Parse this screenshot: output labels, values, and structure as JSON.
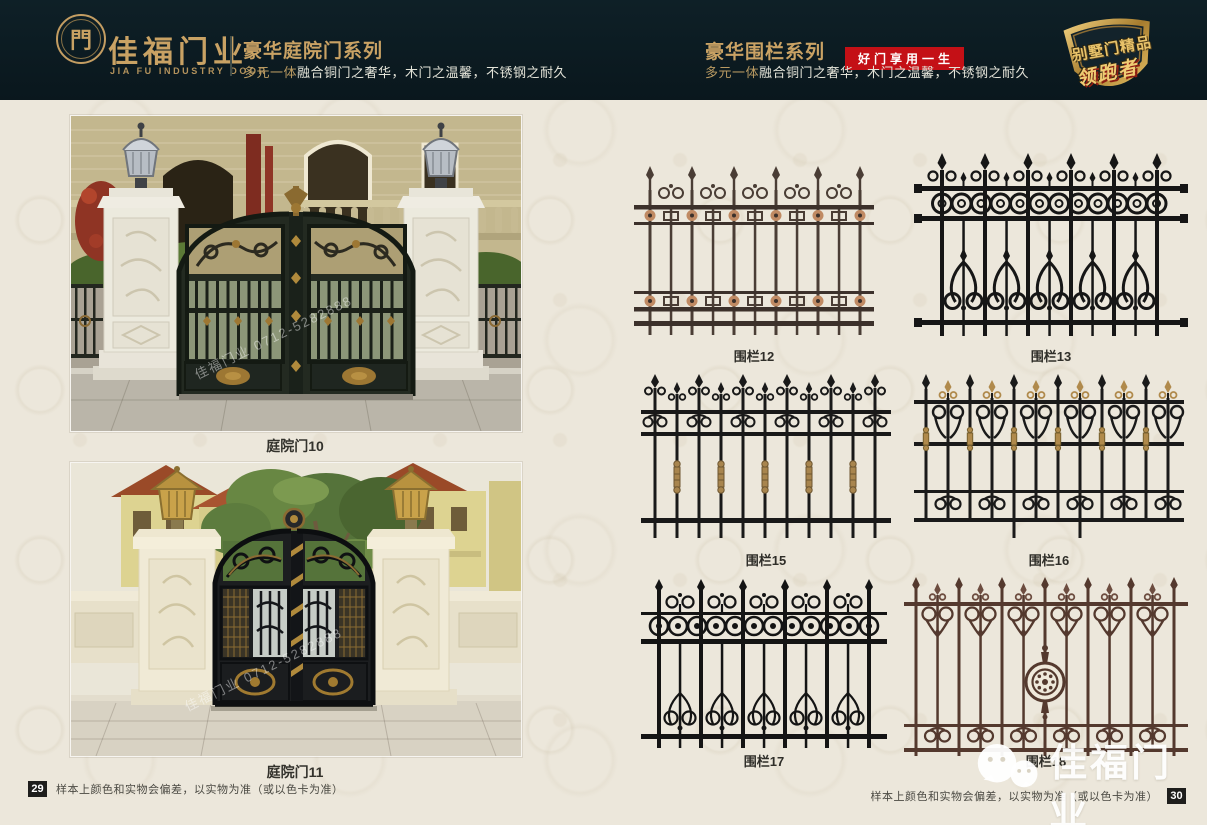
{
  "header": {
    "logo": {
      "glyph": "門",
      "brand_cn": "佳福门业",
      "brand_en": "JIA FU INDUSTRY DOOR"
    },
    "series_left": {
      "title": "豪华庭院门系列",
      "subtitle_em": "多元一体",
      "subtitle_rest": "融合铜门之奢华，木门之温馨，不锈钢之耐久"
    },
    "series_right": {
      "title": "豪华围栏系列",
      "badge": "好门享用一生",
      "subtitle_em": "多元一体",
      "subtitle_rest": "融合铜门之奢华，木门之温馨，不锈钢之耐久"
    },
    "emblem": {
      "line1": "别墅门精品",
      "line2": "领跑者"
    }
  },
  "gates": {
    "items": [
      {
        "label": "庭院门10"
      },
      {
        "label": "庭院门11"
      }
    ],
    "photo_watermark": "佳福门业 0712-5282888"
  },
  "fences": {
    "items": [
      {
        "label": "围栏12",
        "color": "#4a3d35"
      },
      {
        "label": "围栏13",
        "color": "#161616"
      },
      {
        "label": "围栏15",
        "color": "#191919"
      },
      {
        "label": "围栏16",
        "color": "#1a1a1a"
      },
      {
        "label": "围栏17",
        "color": "#141414"
      },
      {
        "label": "围栏18",
        "color": "#54392e"
      }
    ]
  },
  "footer": {
    "left": {
      "page": "29",
      "note": "样本上颜色和实物会偏差，以实物为准（或以色卡为准）"
    },
    "right": {
      "page": "30",
      "note": "样本上颜色和实物会偏差，以实物为准（或以色卡为准）"
    }
  },
  "watermark": {
    "brand": "佳福门业"
  },
  "colors": {
    "header_bg": "#0c1c23",
    "gold": "#c9a264",
    "badge_red": "#c41016",
    "page_bg": "#ece7db",
    "fence_gold_accent": "#b08a4c",
    "rosette_copper": "#c08a63"
  }
}
